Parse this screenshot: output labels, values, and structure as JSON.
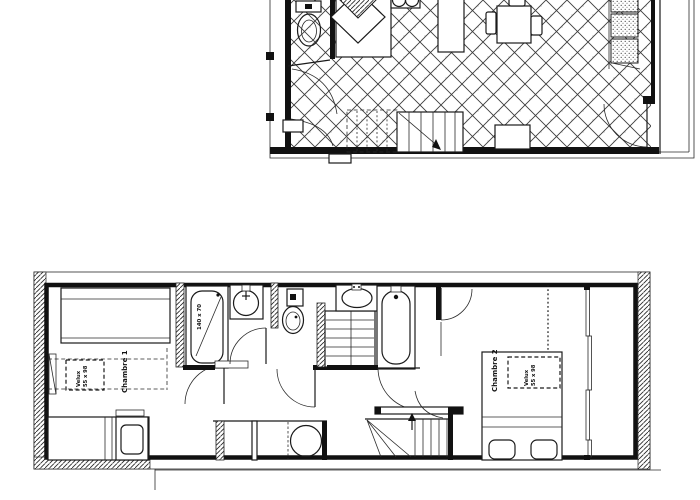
{
  "document": {
    "type": "architectural-floor-plan",
    "style": "black-and-white line drawing",
    "background_color": "#ffffff",
    "line_color": "#1a1a1a"
  },
  "plans": {
    "upper": {
      "name": "upper floor (living / kitchen level)",
      "rooms": [
        {
          "name": "wc",
          "fixtures": [
            "toilet"
          ]
        },
        {
          "name": "kitchen-living",
          "fixtures": [
            "corner-sink",
            "stove-2-burners",
            "counter",
            "dining-table",
            "chairs",
            "sofa-units",
            "staircase-down",
            "balcony-door"
          ]
        }
      ]
    },
    "lower": {
      "name": "lower floor (bedroom level)",
      "rooms": [
        {
          "name": "chambre-1",
          "fixtures": [
            "single-bed",
            "roof-window",
            "radiator",
            "vanity-unit"
          ]
        },
        {
          "name": "bathroom-1",
          "fixtures": [
            "bathtub",
            "washbasin"
          ]
        },
        {
          "name": "wc",
          "fixtures": [
            "toilet"
          ]
        },
        {
          "name": "bathroom-2",
          "fixtures": [
            "washbasin",
            "bathtub"
          ]
        },
        {
          "name": "chambre-2",
          "fixtures": [
            "double-bed",
            "roof-window",
            "window-wall"
          ]
        },
        {
          "name": "hall",
          "fixtures": [
            "closets",
            "washing-machine",
            "staircase-up"
          ]
        }
      ]
    }
  },
  "labels": {
    "chambre1": "Chambre 1",
    "chambre2": "Chambre 2",
    "velux_line1": "Velux",
    "velux_line2": "55 x 98",
    "bathtub1_size": "140 x 70"
  }
}
